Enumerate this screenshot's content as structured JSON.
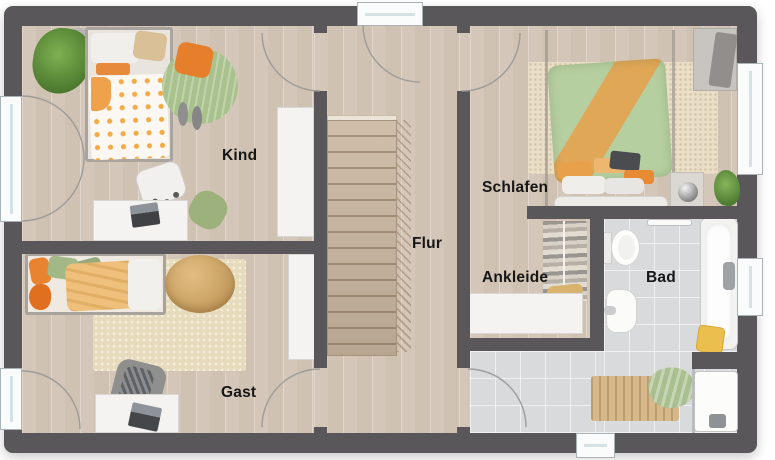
{
  "floorplan": {
    "rooms": {
      "kind": {
        "label": "Kind"
      },
      "gast": {
        "label": "Gast"
      },
      "flur": {
        "label": "Flur"
      },
      "schlafen": {
        "label": "Schlafen"
      },
      "ankleide": {
        "label": "Ankleide"
      },
      "bad": {
        "label": "Bad"
      }
    },
    "elements": {
      "windows": [
        "kind-west",
        "gast-west",
        "flur-north",
        "schlafen-east",
        "bad-east",
        "bad-south"
      ],
      "doors": [
        "kind-door",
        "schlafen-door",
        "gast-door",
        "bad-door"
      ],
      "stairs": "flur-staircase",
      "fixtures": [
        "toilet",
        "sink",
        "bathtub",
        "shower",
        "towel-rail",
        "clothes-rail",
        "yellow-stool"
      ],
      "furniture": [
        "bed-kind",
        "desk-kind",
        "chair-kind",
        "wardrobe-kind",
        "round-rug-kind",
        "plant-kind",
        "bed-gast",
        "rug-gast",
        "armchair-gast",
        "desk-gast",
        "pouf-gast",
        "wardrobe-gast",
        "bed-schlafen",
        "rug-schlafen",
        "wardrobe-schlafen",
        "nightstand-lamp",
        "plant-schlafen",
        "sideboard-ankleide",
        "bath-mat",
        "towel-green"
      ]
    },
    "colors": {
      "wall": "#595759",
      "wood_floor": "#d9cdc0",
      "tile_floor": "#d9dadc",
      "stair_wood": "#c7b59f",
      "accent_orange": "#e8863a",
      "accent_green": "#a9c18c",
      "accent_yellow": "#eabf4e",
      "rug_beige": "#e6dcbd"
    }
  }
}
